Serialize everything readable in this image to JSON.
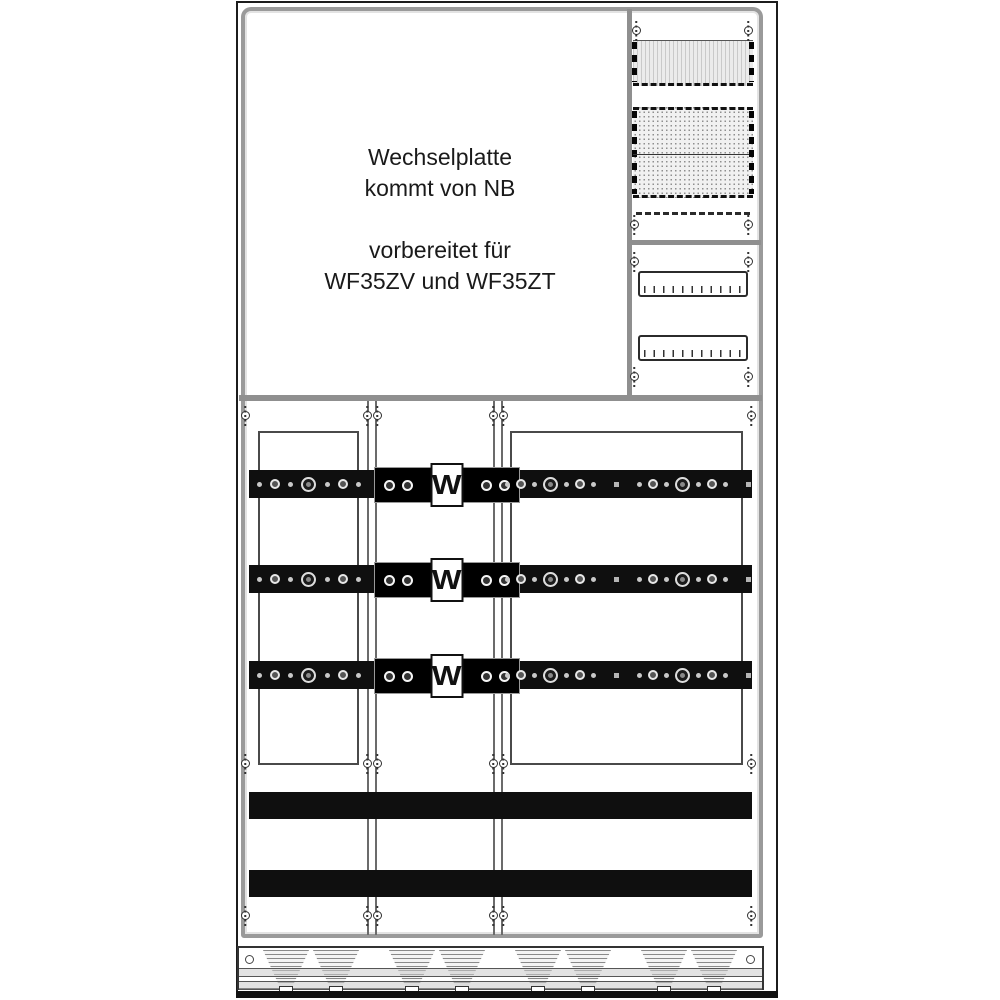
{
  "note": {
    "line1": "Wechselplatte",
    "line2": "kommt von NB",
    "line3": "",
    "line4": "vorbereitet für",
    "line5": "WF35ZV und WF35ZT"
  },
  "busbars": [
    {
      "label": "W"
    },
    {
      "label": "W"
    },
    {
      "label": "W"
    }
  ],
  "colors": {
    "busbar_black": "#0f0f0f",
    "frame_gray": "#9a9a9a",
    "line_dark": "#2b2b2b",
    "background": "#ffffff"
  }
}
